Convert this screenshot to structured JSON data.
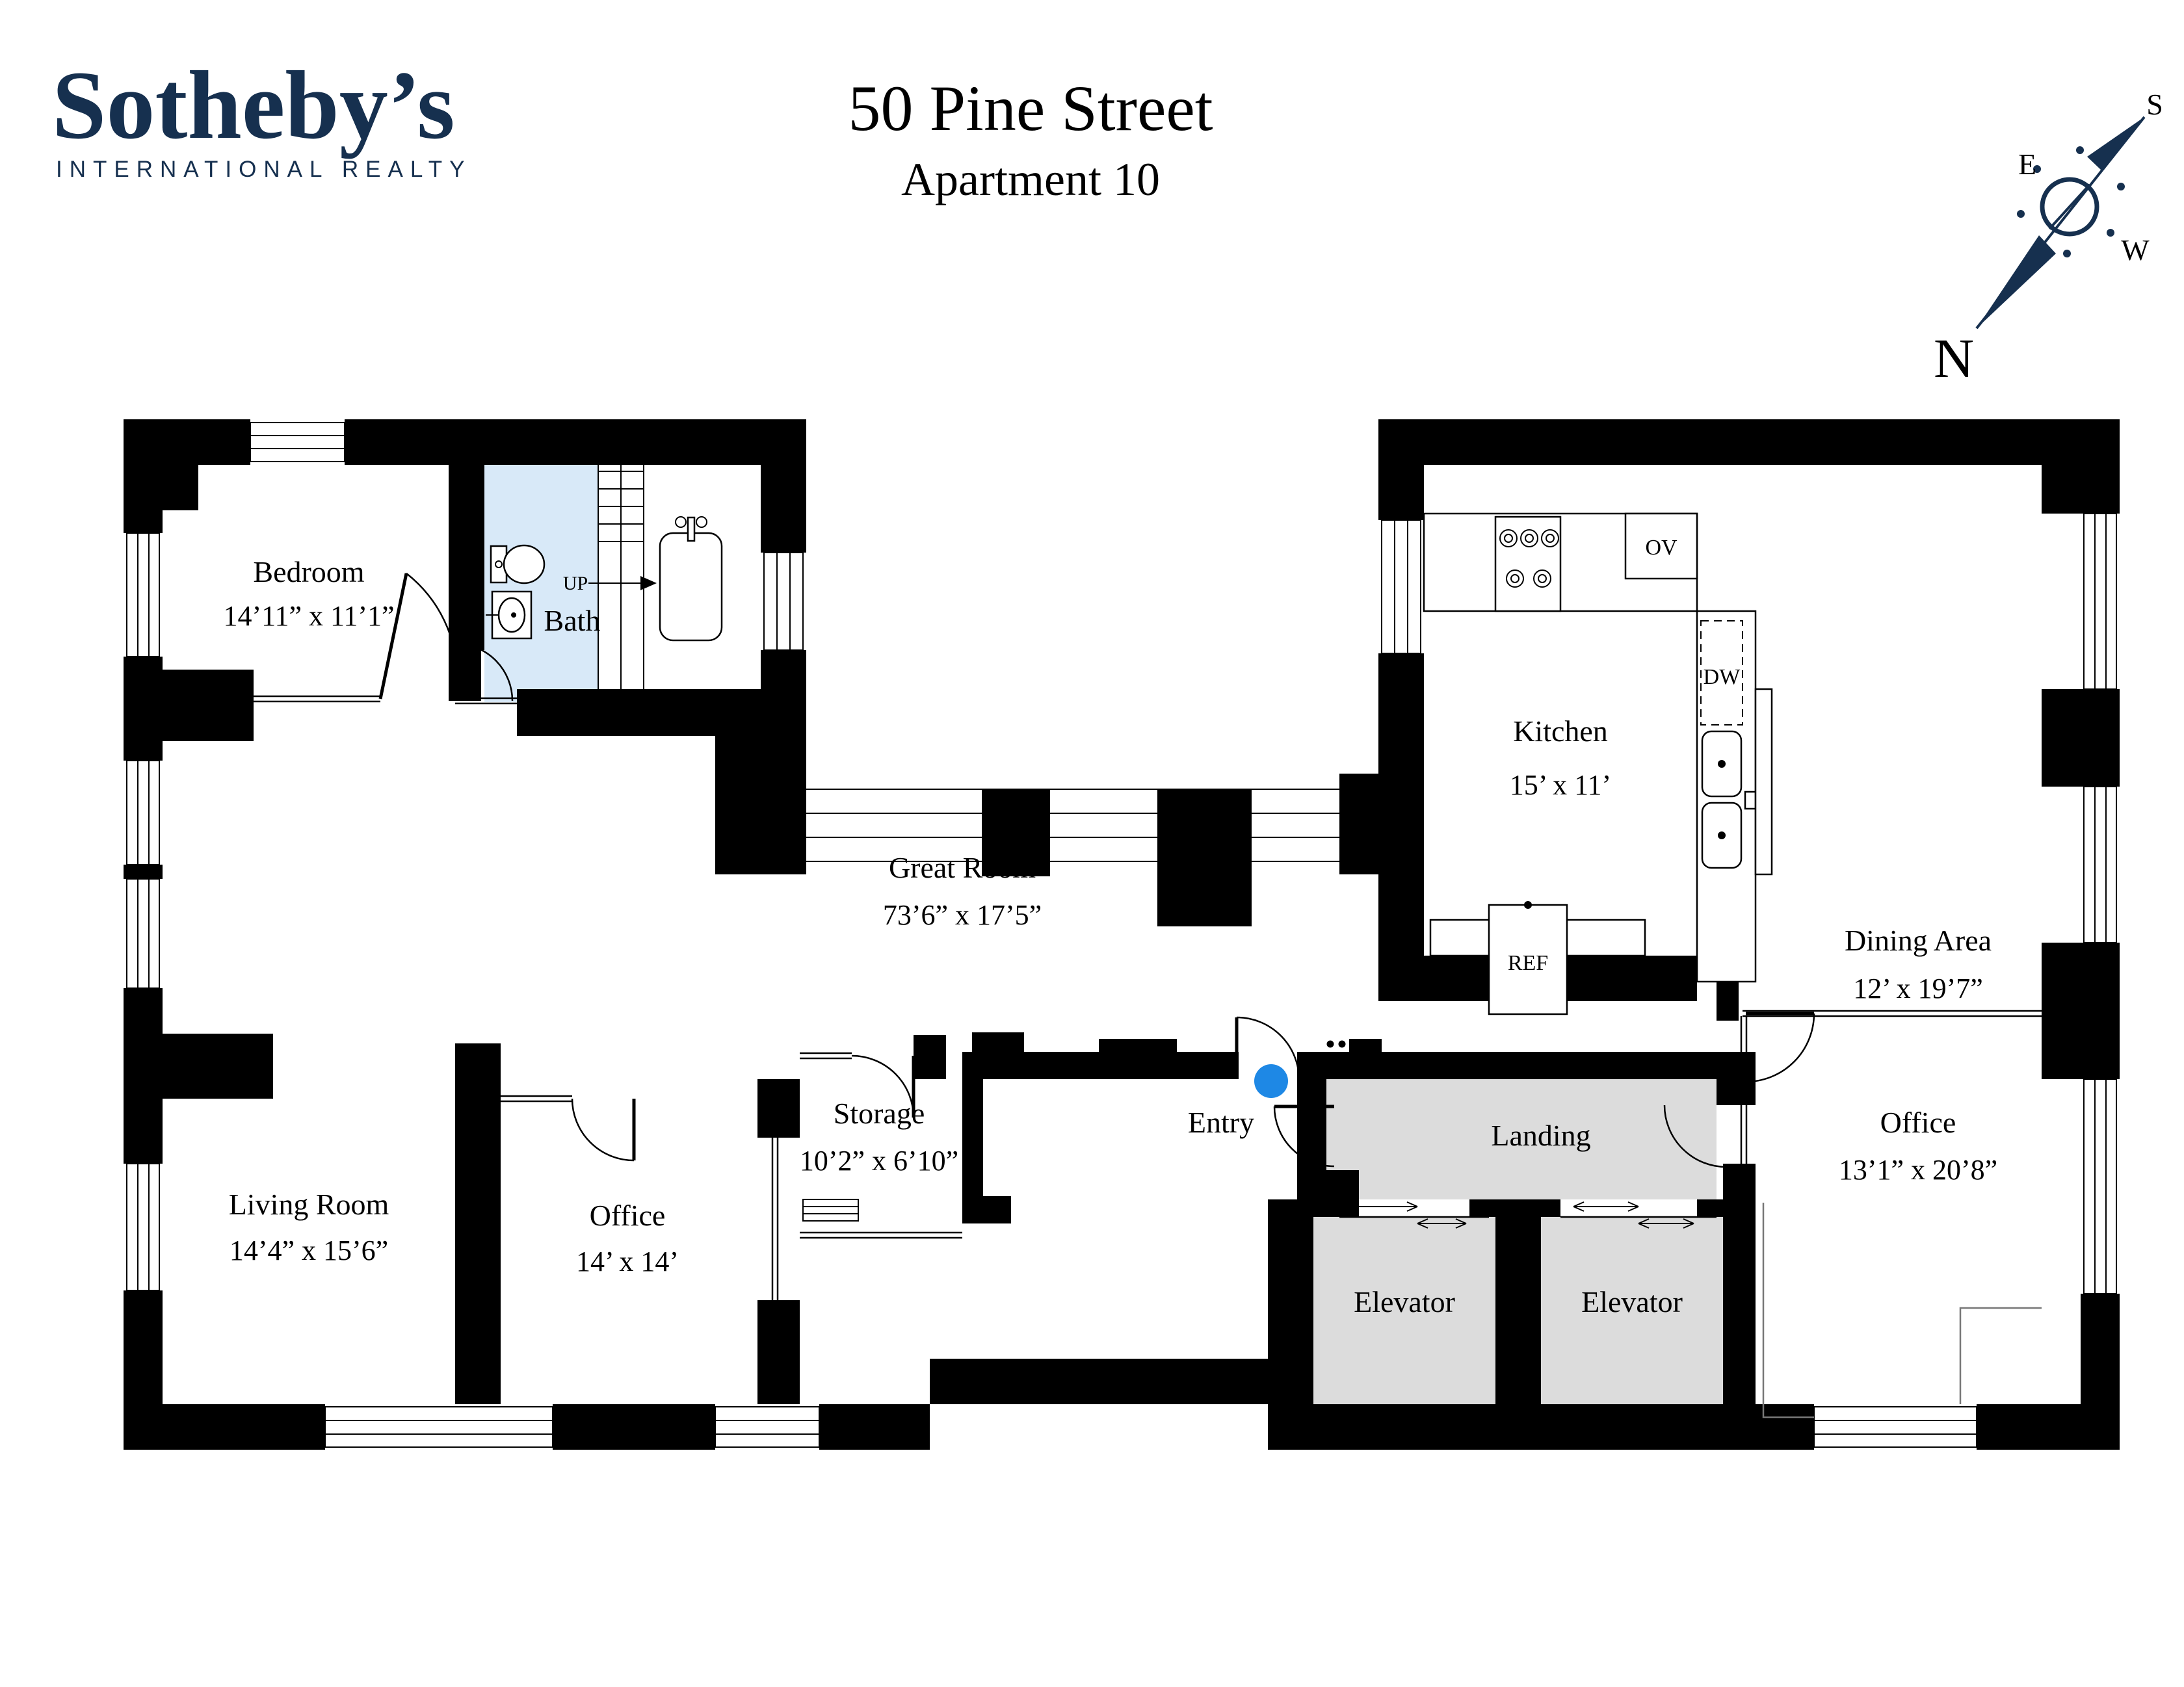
{
  "header": {
    "brand": "Sotheby’s",
    "brand_sub": "INTERNATIONAL REALTY",
    "title": "50 Pine Street",
    "subtitle": "Apartment 10"
  },
  "compass": {
    "n": "N",
    "e": "E",
    "s": "S",
    "w": "W"
  },
  "colors": {
    "navy": "#16304f",
    "bath": "#d8e9f8",
    "core": "#dcdcdc",
    "entry_dot": "#1e88e5"
  },
  "rooms": {
    "bedroom": {
      "name": "Bedroom",
      "dims": "14’11” x 11’1”"
    },
    "bath": {
      "name": "Bath"
    },
    "kitchen": {
      "name": "Kitchen",
      "dims": "15’ x 11’"
    },
    "dining": {
      "name": "Dining Area",
      "dims": "12’ x 19’7”"
    },
    "great_room": {
      "name": "Great Room",
      "dims": "73’6” x 17’5”"
    },
    "living_room": {
      "name": "Living Room",
      "dims": "14’4” x 15’6”"
    },
    "office_small": {
      "name": "Office",
      "dims": "14’ x 14’"
    },
    "storage": {
      "name": "Storage",
      "dims": "10’2” x 6’10”"
    },
    "entry": {
      "name": "Entry"
    },
    "landing": {
      "name": "Landing"
    },
    "elevator_left": {
      "name": "Elevator"
    },
    "elevator_right": {
      "name": "Elevator"
    },
    "office_large": {
      "name": "Office",
      "dims": "13’1” x 20’8”"
    }
  },
  "fixtures": {
    "oven": "OV",
    "dishwasher": "DW",
    "refrigerator": "REF",
    "stairs_up": "UP"
  }
}
